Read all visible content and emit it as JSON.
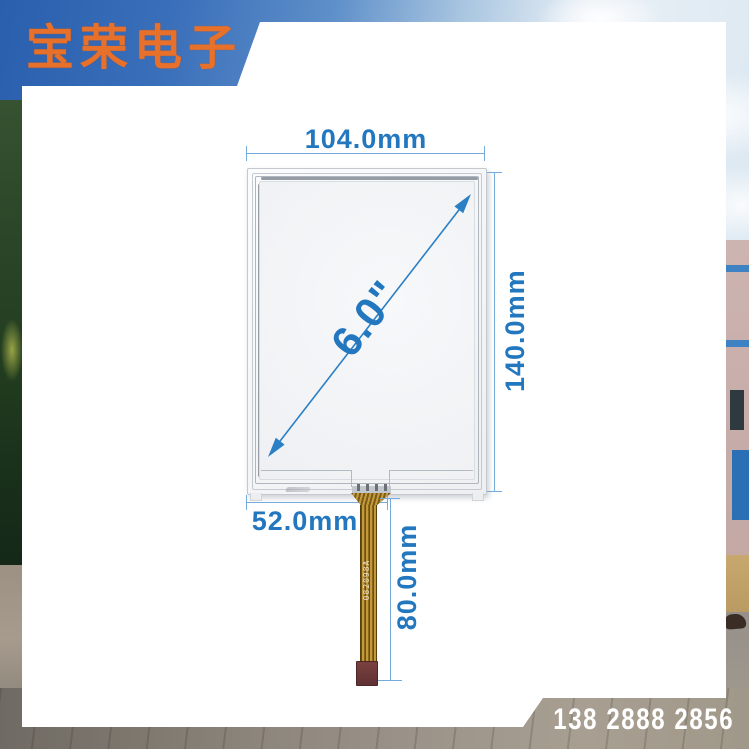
{
  "header": {
    "logo_text": "宝荣电子"
  },
  "footer": {
    "phone": "138 2888 2856"
  },
  "diagram": {
    "size_label": "6.0\"",
    "width_label": "104.0mm",
    "height_label": "140.0mm",
    "tail_offset_label": "52.0mm",
    "tail_length_label": "80.0mm",
    "cable_marking": "082098A"
  },
  "colors": {
    "dimension_blue": "#2277bf",
    "dimension_line_blue": "#74aadc",
    "logo_orange": "#e7712b",
    "phone_white": "#ffffff",
    "fpc_gold": "#c3983e",
    "connector_maroon": "#6f383b",
    "sky_blue": "#3a6fba"
  }
}
